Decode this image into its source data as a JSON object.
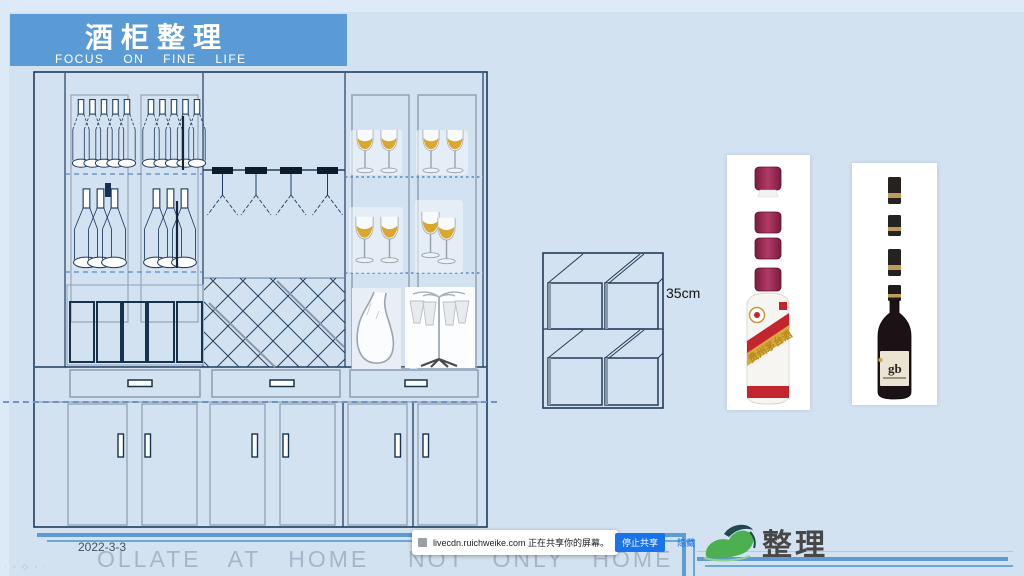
{
  "header": {
    "title": "酒柜整理",
    "subtitle": "FOCUS ON FINE LIFE"
  },
  "annotations": {
    "box_height": "35cm",
    "date": "2022-3-3"
  },
  "watermark": {
    "left": "OLLATE AT HOME",
    "right": "NOT ONLY HOME",
    "corner": "· ◦ ◇ ◦ ·"
  },
  "share_bar": {
    "message": "livecdn.ruichweike.com 正在共享你的屏幕。",
    "stop": "停止共享",
    "hide": "隐藏"
  },
  "logo": {
    "text": "整理"
  },
  "products": {
    "maotai": {
      "label": "贵州茅台酒"
    },
    "wine": {
      "label": "gb"
    }
  },
  "colors": {
    "banner_blue": "#5b9bd5",
    "line_dark": "#1e3c5f",
    "maotai_red": "#c3242e",
    "wine_gold": "#d9a62e",
    "share_button_blue": "#1a73e8",
    "footer_line_blue": "#5f9bd0"
  }
}
